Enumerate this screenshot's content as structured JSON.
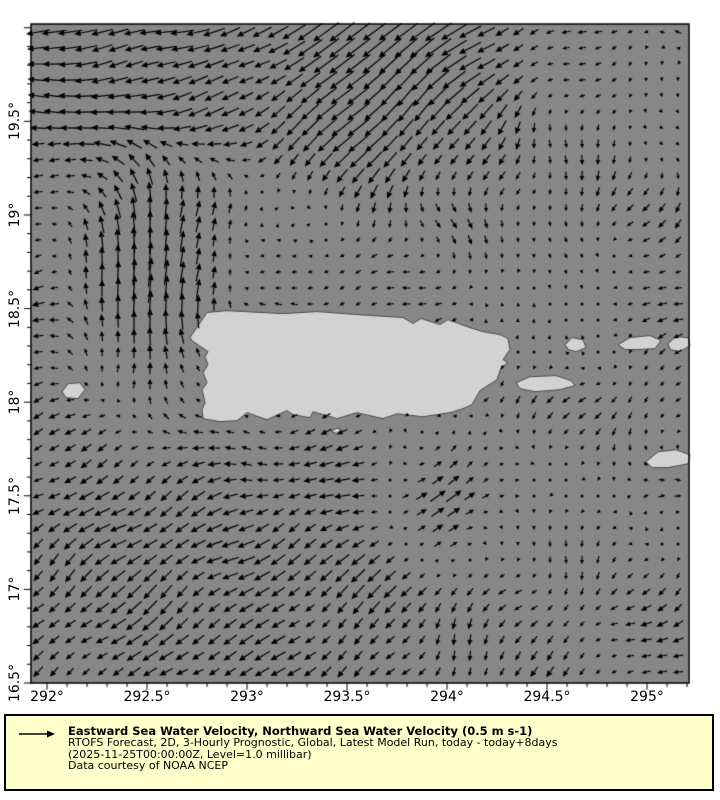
{
  "chart_data": {
    "type": "quiver",
    "description": "Gridded sea-water velocity vector field over the Puerto Rico region; arrows on a regular grid over a gray sea with light-gray land masses.",
    "x_axis": {
      "ticks": [
        292,
        292.5,
        293,
        293.5,
        294,
        294.5,
        295
      ],
      "tick_labels": [
        "292°",
        "292.5°",
        "293°",
        "293.5°",
        "294°",
        "294.5°",
        "295°"
      ],
      "range": [
        291.92,
        295.21
      ],
      "minor_step": 0.1
    },
    "y_axis": {
      "ticks": [
        16.5,
        17,
        17.5,
        18,
        18.5,
        19,
        19.5
      ],
      "tick_labels": [
        "16.5°",
        "17°",
        "17.5°",
        "18°",
        "18.5°",
        "19°",
        "19.5°"
      ],
      "range": [
        16.5,
        20.02
      ],
      "minor_step": 0.1
    },
    "reference_vector": {
      "speed": 0.5,
      "units": "m s-1"
    },
    "uv_grid": {
      "lons": [
        292,
        292.5,
        293,
        293.5,
        294,
        294.5,
        295
      ],
      "lats": [
        20,
        19.5,
        19,
        18.5,
        18,
        17.5,
        17,
        16.5
      ],
      "uv": [
        [
          [
            -0.5,
            -0.05
          ],
          [
            -0.45,
            -0.1
          ],
          [
            -0.4,
            -0.2
          ],
          [
            -0.5,
            -0.35
          ],
          [
            -0.55,
            -0.4
          ],
          [
            -0.2,
            -0.02
          ],
          [
            -0.15,
            0.02
          ]
        ],
        [
          [
            -0.4,
            0.0
          ],
          [
            -0.45,
            -0.05
          ],
          [
            -0.3,
            -0.15
          ],
          [
            -0.45,
            -0.45
          ],
          [
            -0.35,
            -0.35
          ],
          [
            -0.06,
            -0.15
          ],
          [
            0.05,
            -0.1
          ]
        ],
        [
          [
            -0.15,
            -0.05
          ],
          [
            0.05,
            0.65
          ],
          [
            0.1,
            0.1
          ],
          [
            -0.05,
            -0.15
          ],
          [
            0.08,
            -0.15
          ],
          [
            0.0,
            -0.18
          ],
          [
            -0.1,
            -0.15
          ]
        ],
        [
          [
            -0.2,
            0.0
          ],
          [
            0.1,
            0.6
          ],
          [
            -0.15,
            0.05
          ],
          [
            -0.18,
            0.0
          ],
          [
            -0.15,
            -0.05
          ],
          [
            0.1,
            0.08
          ],
          [
            -0.15,
            0.0
          ]
        ],
        [
          [
            -0.15,
            -0.1
          ],
          [
            -0.05,
            0.1
          ],
          [
            -0.1,
            0.05
          ],
          [
            -0.15,
            -0.05
          ],
          [
            -0.1,
            -0.1
          ],
          [
            -0.1,
            -0.1
          ],
          [
            -0.1,
            -0.15
          ]
        ],
        [
          [
            -0.25,
            -0.15
          ],
          [
            -0.3,
            -0.2
          ],
          [
            -0.3,
            -0.05
          ],
          [
            -0.3,
            -0.12
          ],
          [
            0.4,
            0.28
          ],
          [
            -0.05,
            -0.08
          ],
          [
            0.1,
            0.02
          ]
        ],
        [
          [
            -0.25,
            -0.2
          ],
          [
            -0.3,
            -0.25
          ],
          [
            -0.3,
            -0.2
          ],
          [
            -0.25,
            -0.25
          ],
          [
            -0.15,
            -0.15
          ],
          [
            -0.06,
            -0.15
          ],
          [
            -0.15,
            -0.1
          ]
        ],
        [
          [
            -0.2,
            -0.15
          ],
          [
            -0.25,
            -0.2
          ],
          [
            -0.25,
            -0.1
          ],
          [
            -0.2,
            -0.2
          ],
          [
            -0.06,
            -0.2
          ],
          [
            -0.15,
            -0.15
          ],
          [
            -0.2,
            -0.05
          ]
        ]
      ]
    }
  },
  "map": {
    "colors": {
      "sea": "#878787",
      "land": "#d2d2d2",
      "coast": "#4a4a4a",
      "arrow": "#000000",
      "axis": "#000000",
      "legend_bg": "#ffffcc"
    },
    "islands": {
      "puerto_rico": [
        [
          292.715,
          18.345
        ],
        [
          292.8,
          18.479
        ],
        [
          292.9,
          18.489
        ],
        [
          293.18,
          18.473
        ],
        [
          293.35,
          18.484
        ],
        [
          293.55,
          18.468
        ],
        [
          293.78,
          18.452
        ],
        [
          293.83,
          18.42
        ],
        [
          293.87,
          18.447
        ],
        [
          293.965,
          18.415
        ],
        [
          294.005,
          18.441
        ],
        [
          294.115,
          18.398
        ],
        [
          294.18,
          18.377
        ],
        [
          294.265,
          18.361
        ],
        [
          294.305,
          18.34
        ],
        [
          294.315,
          18.281
        ],
        [
          294.28,
          18.227
        ],
        [
          294.305,
          18.211
        ],
        [
          294.27,
          18.184
        ],
        [
          294.25,
          18.12
        ],
        [
          294.165,
          18.062
        ],
        [
          294.125,
          17.987
        ],
        [
          294.08,
          17.965
        ],
        [
          294.015,
          17.944
        ],
        [
          293.88,
          17.922
        ],
        [
          293.75,
          17.938
        ],
        [
          293.68,
          17.912
        ],
        [
          293.55,
          17.944
        ],
        [
          293.45,
          17.912
        ],
        [
          293.33,
          17.949
        ],
        [
          293.315,
          17.917
        ],
        [
          293.23,
          17.933
        ],
        [
          293.2,
          17.955
        ],
        [
          293.1,
          17.906
        ],
        [
          293.0,
          17.944
        ],
        [
          292.95,
          17.901
        ],
        [
          292.865,
          17.896
        ],
        [
          292.78,
          17.912
        ],
        [
          292.775,
          17.96
        ],
        [
          292.79,
          17.997
        ],
        [
          292.775,
          18.067
        ],
        [
          292.8,
          18.104
        ],
        [
          292.78,
          18.158
        ],
        [
          292.805,
          18.2
        ],
        [
          292.79,
          18.243
        ],
        [
          292.805,
          18.27
        ],
        [
          292.73,
          18.324
        ]
      ],
      "mona": [
        [
          292.075,
          18.056
        ],
        [
          292.105,
          18.099
        ],
        [
          292.165,
          18.104
        ],
        [
          292.19,
          18.067
        ],
        [
          292.155,
          18.019
        ],
        [
          292.095,
          18.024
        ]
      ],
      "caja_de_muertos": [
        [
          293.42,
          17.845
        ],
        [
          293.45,
          17.862
        ],
        [
          293.475,
          17.85
        ],
        [
          293.445,
          17.833
        ]
      ],
      "vieques": [
        [
          294.345,
          18.104
        ],
        [
          294.415,
          18.136
        ],
        [
          294.545,
          18.142
        ],
        [
          294.62,
          18.115
        ],
        [
          294.64,
          18.088
        ],
        [
          294.565,
          18.067
        ],
        [
          294.44,
          18.056
        ],
        [
          294.365,
          18.072
        ]
      ],
      "culebra": [
        [
          294.59,
          18.307
        ],
        [
          294.625,
          18.345
        ],
        [
          294.68,
          18.334
        ],
        [
          294.695,
          18.291
        ],
        [
          294.645,
          18.27
        ],
        [
          294.605,
          18.281
        ]
      ],
      "st_thomas": [
        [
          294.855,
          18.307
        ],
        [
          294.915,
          18.345
        ],
        [
          295.015,
          18.356
        ],
        [
          295.07,
          18.329
        ],
        [
          295.04,
          18.286
        ],
        [
          294.955,
          18.281
        ],
        [
          294.89,
          18.281
        ]
      ],
      "tortola": [
        [
          295.105,
          18.313
        ],
        [
          295.145,
          18.35
        ],
        [
          295.205,
          18.345
        ],
        [
          295.215,
          18.302
        ],
        [
          295.165,
          18.27
        ],
        [
          295.115,
          18.281
        ]
      ],
      "st_croix": [
        [
          294.995,
          17.682
        ],
        [
          295.055,
          17.735
        ],
        [
          295.145,
          17.746
        ],
        [
          295.215,
          17.719
        ],
        [
          295.205,
          17.671
        ],
        [
          295.105,
          17.65
        ],
        [
          295.025,
          17.65
        ]
      ]
    }
  },
  "legend": {
    "title": "Eastward Sea Water Velocity, Northward Sea Water Velocity (0.5 m s-1)",
    "line2": "RTOFS Forecast, 2D, 3-Hourly Prognostic, Global, Latest Model Run, today - today+8days",
    "line3": "(2025-11-25T00:00:00Z, Level=1.0 millibar)",
    "line4": "Data courtesy of NOAA NCEP"
  }
}
